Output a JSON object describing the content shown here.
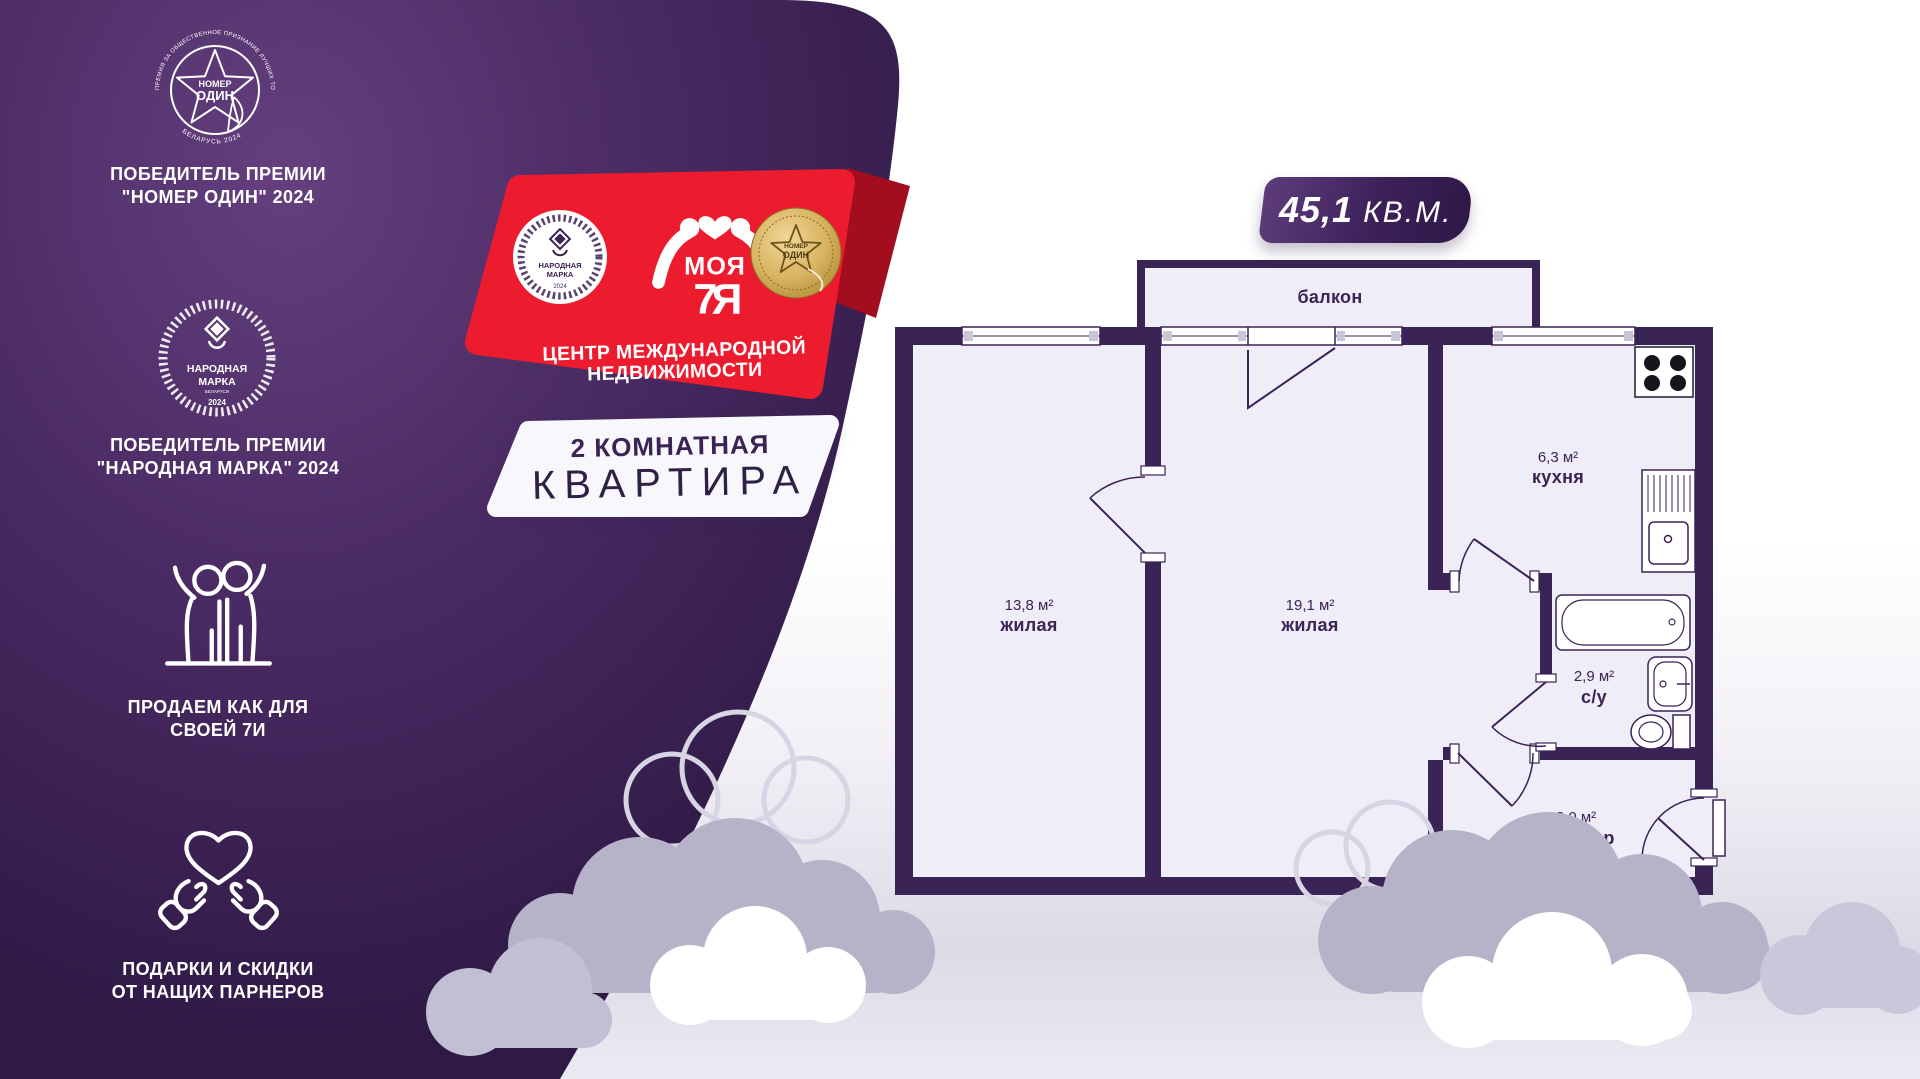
{
  "sidebar": {
    "award1": {
      "ring_top": "ПРЕМИЯ ЗА ОБЩЕСТВЕННОЕ ПРИЗНАНИЕ ЛУЧШИХ ТОВАРОВ И УСЛУГ",
      "ring_bottom": "БЕЛАРУСЬ 2024",
      "medallion_line1": "НОМЕР",
      "medallion_line2": "ОДИН",
      "caption_line1": "ПОБЕДИТЕЛЬ ПРЕМИИ",
      "caption_line2": "\"НОМЕР ОДИН\" 2024"
    },
    "award2": {
      "medallion_line1": "НАРОДНАЯ",
      "medallion_line2": "МАРКА",
      "medallion_sub": "БЕЛАРУСИ",
      "medallion_year": "2024",
      "caption_line1": "ПОБЕДИТЕЛЬ ПРЕМИИ",
      "caption_line2": "\"НАРОДНАЯ МАРКА\" 2024"
    },
    "family_caption_line1": "ПРОДАЕМ КАК ДЛЯ",
    "family_caption_line2": "СВОЕЙ 7И",
    "gifts_caption_line1": "ПОДАРКИ И СКИДКИ",
    "gifts_caption_line2": "ОТ НАЩИХ ПАРНЕРОВ"
  },
  "ribbon": {
    "logo_word": "МОЯ",
    "logo_monogram": "7Я",
    "subtitle_line1": "ЦЕНТР МЕЖДУНАРОДНОЙ",
    "subtitle_line2": "НЕДВИЖИМОСТИ",
    "left_badge": {
      "line1": "НАРОДНАЯ",
      "line2": "МАРКА",
      "year": "2024"
    },
    "medal": {
      "line1": "НОМЕР",
      "line2": "ОДИН"
    }
  },
  "listing": {
    "type_line1": "2 КОМНАТНАЯ",
    "type_line2": "КВАРТИРА",
    "area_value": "45,1",
    "area_unit": "КВ.М."
  },
  "floorplan": {
    "balcony": "балкон",
    "rooms": [
      {
        "area": "13,8 м²",
        "name": "жилая"
      },
      {
        "area": "19,1 м²",
        "name": "жилая"
      },
      {
        "area": "6,3 м²",
        "name": "кухня"
      },
      {
        "area": "2,9 м²",
        "name": "с/у"
      },
      {
        "area": "3,0 м²",
        "name": "коридор"
      }
    ]
  },
  "colors": {
    "brand_purple": "#3a2355",
    "panel_purple_dark": "#2f1a46",
    "accent_red": "#ec1b2e",
    "plan_interior": "#efedf7",
    "cloud_lavender": "#b6b3c9",
    "gold": "#c9a24b"
  }
}
